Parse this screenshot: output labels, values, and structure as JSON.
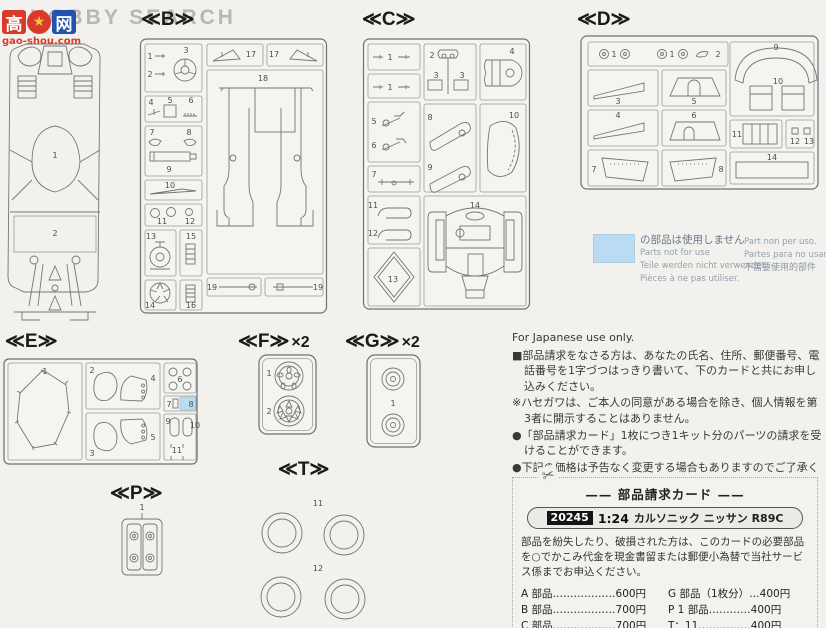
{
  "colors": {
    "highlight_blue": "#badcf2",
    "logo_red": "#d93a2b",
    "logo_blue": "#2352b0",
    "watermark_gray": "#b9b6b6",
    "paper": "#f2f1ed"
  },
  "watermark": {
    "brand_text": "HOBBY SEARCH",
    "logo_char_left": "高",
    "logo_char_right": "网",
    "logo_fist": "★",
    "logo_domain": "gao-shou.com"
  },
  "sprues": {
    "a": {
      "parts": [
        "1",
        "2"
      ]
    },
    "b": {
      "label": "≪B≫",
      "parts": [
        "1",
        "2",
        "3",
        "4",
        "5",
        "6",
        "7",
        "8",
        "9",
        "10",
        "11",
        "12",
        "13",
        "15",
        "14",
        "16",
        "17",
        "17",
        "18",
        "19",
        "19"
      ]
    },
    "c": {
      "label": "≪C≫",
      "parts": [
        "1",
        "1",
        "2",
        "3",
        "3",
        "4",
        "5",
        "6",
        "7",
        "8",
        "9",
        "10",
        "11",
        "12",
        "13",
        "14"
      ]
    },
    "d": {
      "label": "≪D≫",
      "parts": [
        "1",
        "1",
        "2",
        "3",
        "5",
        "4",
        "6",
        "7",
        "8",
        "9",
        "10",
        "11",
        "12",
        "13",
        "14"
      ]
    },
    "e": {
      "label": "≪E≫",
      "parts": [
        "1",
        "2",
        "4",
        "3",
        "5",
        "6",
        "7",
        "8",
        "9",
        "10",
        "11"
      ]
    },
    "f": {
      "label": "≪F≫",
      "multiplier": "×2",
      "parts": [
        "1",
        "2"
      ]
    },
    "g": {
      "label": "≪G≫",
      "multiplier": "×2",
      "parts": [
        "1"
      ]
    },
    "p": {
      "label": "≪P≫",
      "parts": [
        "1"
      ]
    },
    "t": {
      "label": "≪T≫",
      "parts": [
        "11",
        "12"
      ]
    }
  },
  "legend": {
    "ja": "の部品は使用しません",
    "en": "Parts not for use",
    "de": "Teile werden nicht verwendet",
    "fr": "Pièces à ne pas utiliser.",
    "it": "Part non per uso.",
    "es": "Partes para no usar.",
    "zh": "不需要使用的部件"
  },
  "notice": {
    "heading": "For Japanese use only.",
    "paragraphs": [
      "■部品請求をなさる方は、あなたの氏名、住所、郵便番号、電話番号を1字づつはっきり書いて、下のカードと共にお申し込みください。",
      "※ハセガワは、ご本人の同意がある場合を除き、個人情報を第3者に開示することはありません。",
      "●「部品請求カード」1枚につき1キット分のパーツの請求を受けることができます。",
      "●下記の価格は予告なく変更する場合もありますのでご了承ください。"
    ]
  },
  "card": {
    "scissors_glyph": "✂",
    "title": "—— 部品請求カード ——",
    "product_no": "20245",
    "scale": "1:24",
    "product_name": "カルソニック ニッサン R89C",
    "body": "部品を紛失したり、破損された方は、このカードの必要部品を○でかこみ代金を現金書留または郵便小為替で当社サービス係までお申込ください。",
    "prices": [
      {
        "left": "A 部品………………600円",
        "right": "G 部品（1枚分）…400円"
      },
      {
        "left": "B 部品………………700円",
        "right": "P 1 部品…………400円"
      },
      {
        "left": "C 部品………………700円",
        "right": "T：11……………400円"
      }
    ]
  }
}
